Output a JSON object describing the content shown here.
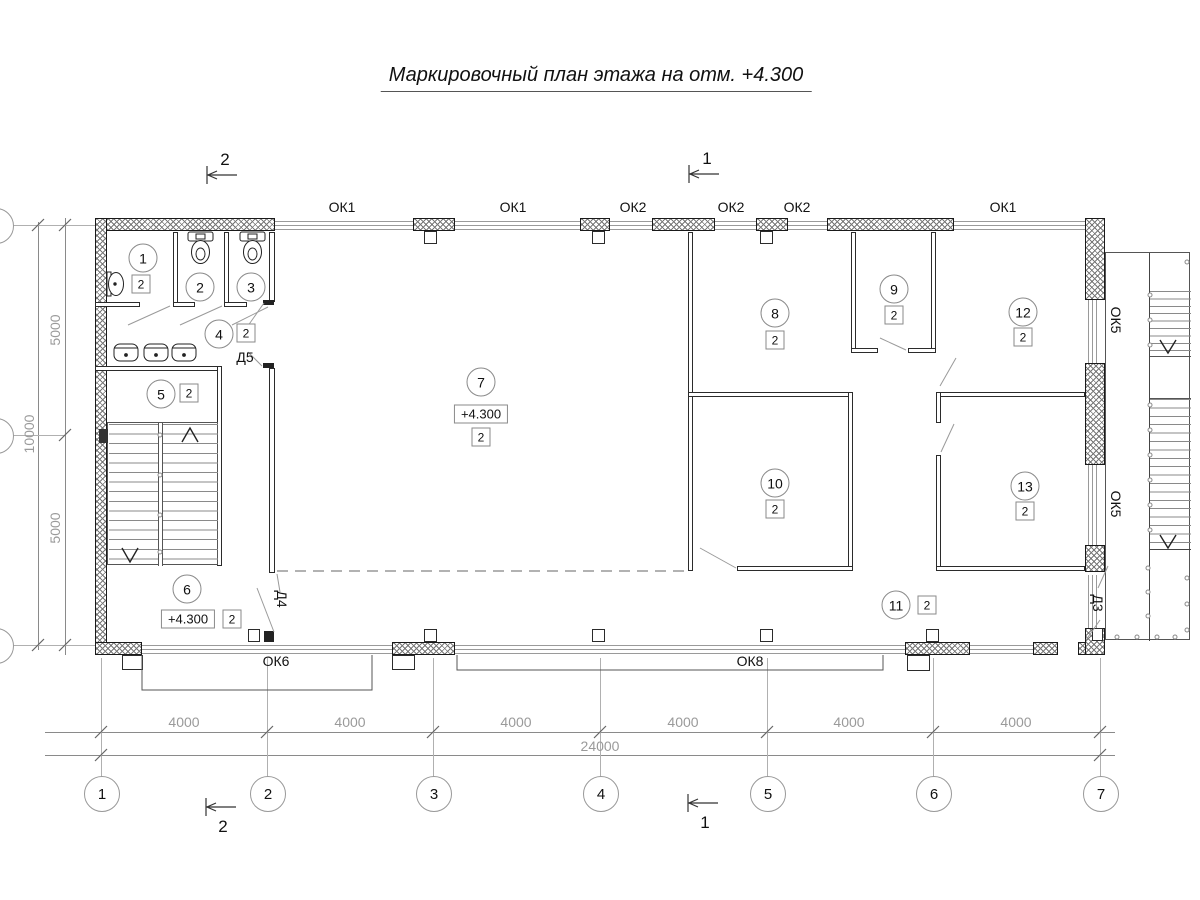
{
  "title": "Маркировочный план этажа на отм. +4.300",
  "section_marks": {
    "top_left": "2",
    "top_center": "1",
    "bottom_left": "2",
    "bottom_center": "1"
  },
  "windows": {
    "top": [
      "ОК1",
      "ОК1",
      "ОК2",
      "ОК2",
      "ОК2",
      "ОК1"
    ],
    "right": [
      "ОК5",
      "ОК5"
    ],
    "bottom": [
      "ОК6",
      "ОК8"
    ]
  },
  "doors": {
    "d5": "Д5",
    "d4": "Д4",
    "d3": "Д3"
  },
  "rooms": {
    "r1": {
      "num": "1",
      "type": "2"
    },
    "r2": {
      "num": "2"
    },
    "r3": {
      "num": "3"
    },
    "r4": {
      "num": "4",
      "type": "2"
    },
    "r5": {
      "num": "5",
      "type": "2"
    },
    "r6": {
      "num": "6",
      "type": "2",
      "elev": "+4.300"
    },
    "r7": {
      "num": "7",
      "type": "2",
      "elev": "+4.300"
    },
    "r8": {
      "num": "8",
      "type": "2"
    },
    "r9": {
      "num": "9",
      "type": "2"
    },
    "r10": {
      "num": "10",
      "type": "2"
    },
    "r11": {
      "num": "11",
      "type": "2"
    },
    "r12": {
      "num": "12",
      "type": "2"
    },
    "r13": {
      "num": "13",
      "type": "2"
    }
  },
  "grid_axes": [
    "1",
    "2",
    "3",
    "4",
    "5",
    "6",
    "7"
  ],
  "dims": {
    "bays": [
      "4000",
      "4000",
      "4000",
      "4000",
      "4000",
      "4000"
    ],
    "total": "24000",
    "left_inner": [
      "5000",
      "5000"
    ],
    "left_outer": "10000"
  }
}
